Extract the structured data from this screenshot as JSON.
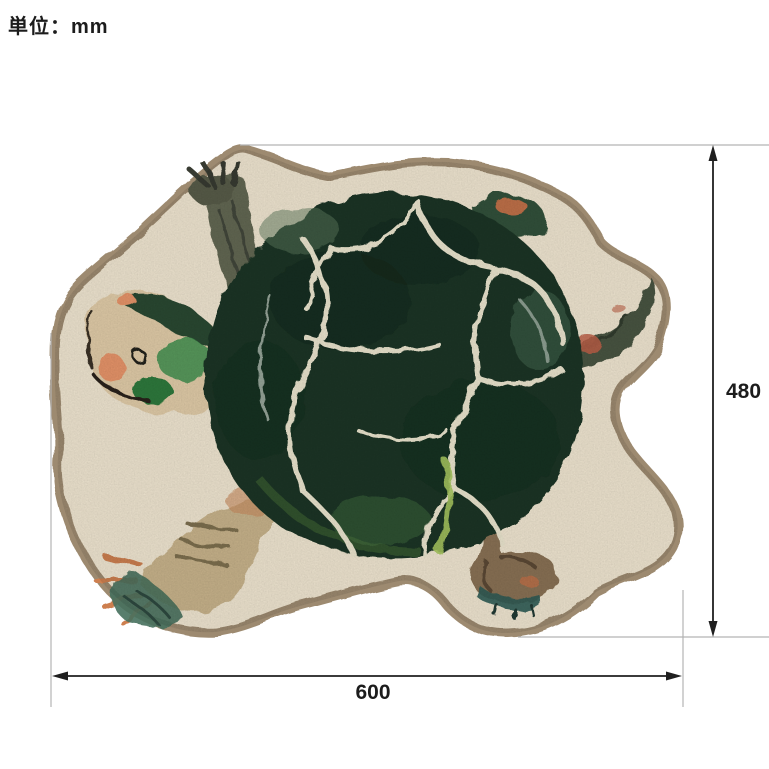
{
  "unit_note": {
    "label": "単位：mm"
  },
  "figure": {
    "name": "turtle-shaped-rug-dimension-diagram",
    "subject": "turtle rug (top view) with outer taupe border, cream ground, dark green cracked shell, head, four legs and tail",
    "dimensions": {
      "width_mm": "600",
      "height_mm": "480",
      "unit": "mm"
    }
  },
  "colors": {
    "label_text": "#1c1c1c",
    "dimension_line": "#1f1f1f",
    "extension_line": "#b3b3b3",
    "rug_border": "#9d8a6f",
    "rug_base": "#f1e7d2",
    "shell_dark_green": "#1d3626",
    "shell_crackle": "#ece6cf",
    "head_skin": "#e2cda9",
    "accent_orange": "#cd7f50",
    "toe_teal": "#47705c"
  }
}
